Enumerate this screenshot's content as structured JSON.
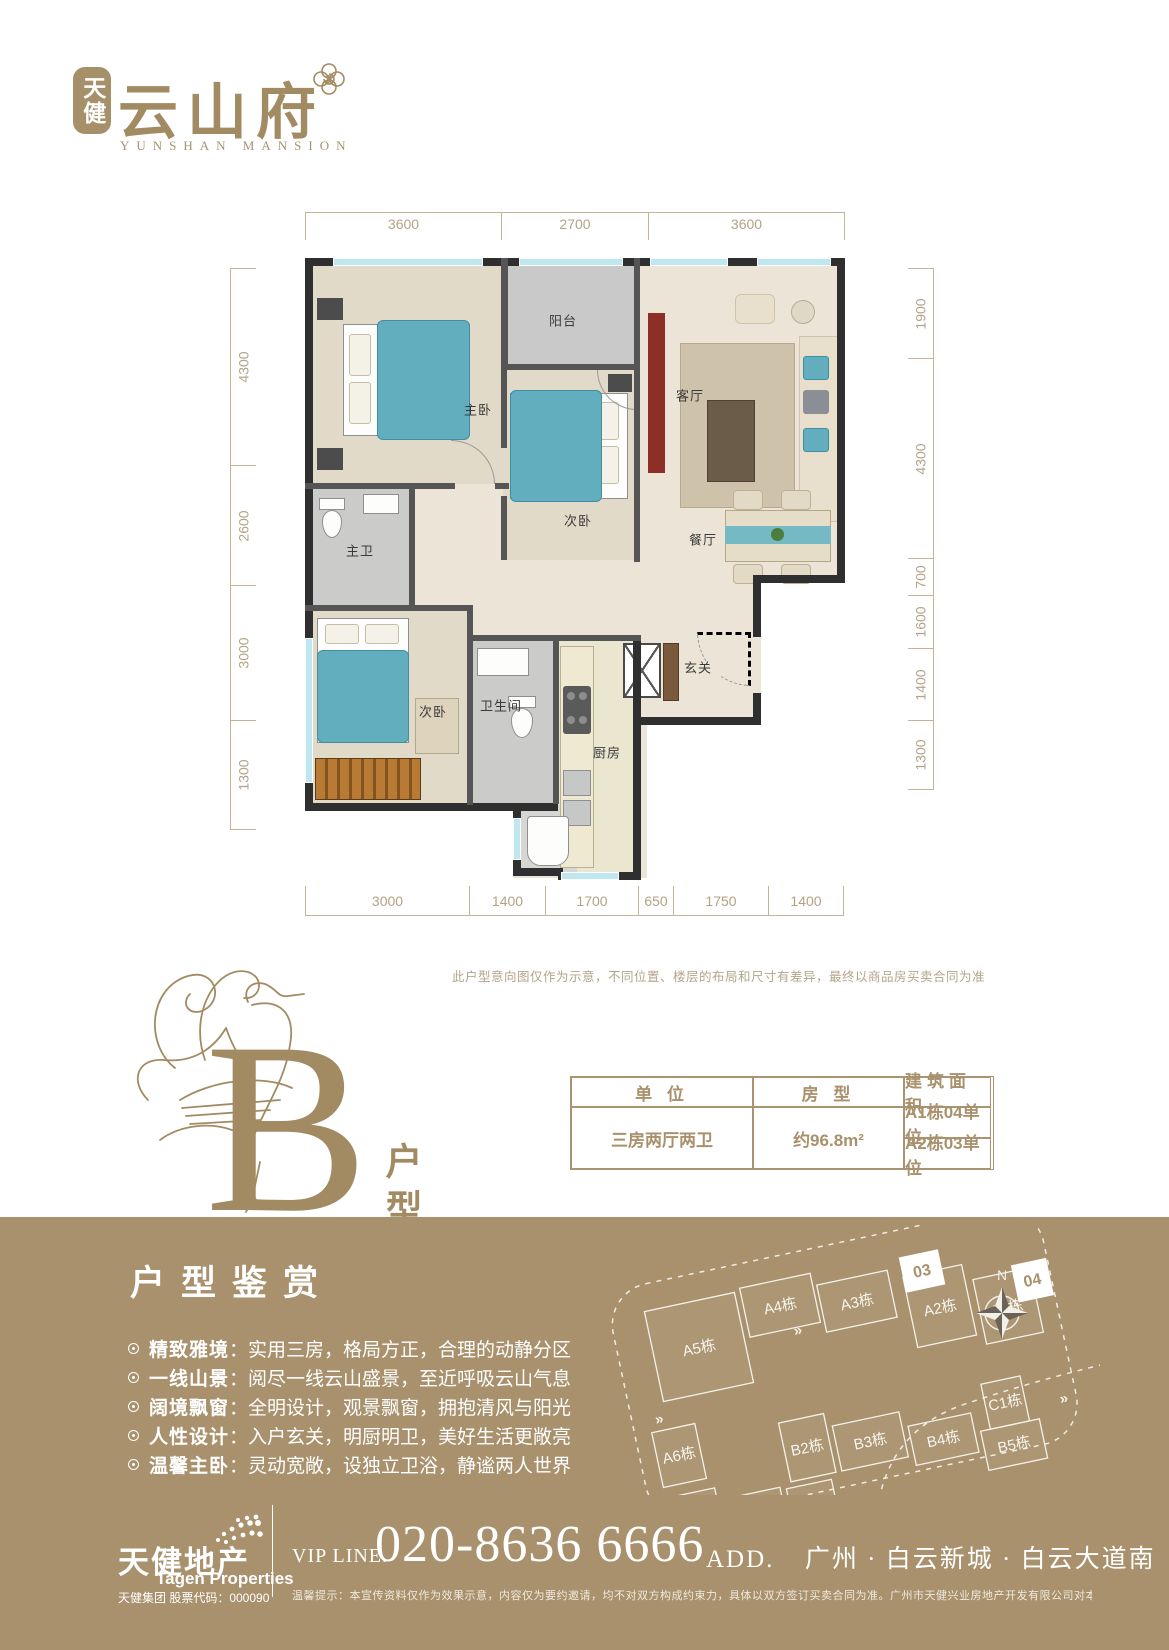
{
  "brand": {
    "badge_chars": "天健",
    "name": "云山府",
    "name_en": "YUNSHAN MANSION"
  },
  "floorplan": {
    "dims_top": [
      "3600",
      "2700",
      "3600"
    ],
    "dims_left": [
      "4300",
      "2600",
      "3000",
      "1300"
    ],
    "dims_right": [
      "1900",
      "4300",
      "700",
      "1600",
      "1400",
      "1300"
    ],
    "dims_bottom": [
      "3000",
      "1400",
      "1700",
      "650",
      "1750",
      "1400"
    ],
    "rooms": {
      "master": "主卧",
      "balcony": "阳台",
      "living": "客厅",
      "bed2": "次卧",
      "dining": "餐厅",
      "masterbath": "主卫",
      "bed3": "次卧",
      "bath": "卫生间",
      "kitchen": "厨房",
      "entry": "玄关"
    },
    "disclaimer": "此户型意向图仅作为示意，不同位置、楼层的布局和尺寸有差异，最终以商品房买卖合同为准"
  },
  "unit": {
    "letter": "B",
    "type_label": "户型",
    "table": {
      "headers": [
        "单 位",
        "房 型",
        "建筑面积"
      ],
      "units": [
        "A1栋04单位",
        "A2栋03单位"
      ],
      "room_type": "三房两厅两卫",
      "area": "约96.8m²"
    }
  },
  "features": {
    "title": "户型鉴赏",
    "colon": "：",
    "items": [
      {
        "label": "精致雅境",
        "text": "实用三房，格局方正，合理的动静分区"
      },
      {
        "label": "一线山景",
        "text": "阅尽一线云山盛景，至近呼吸云山气息"
      },
      {
        "label": "阔境飘窗",
        "text": "全明设计，观景飘窗，拥抱清风与阳光"
      },
      {
        "label": "人性设计",
        "text": "入户玄关，明厨明卫，美好生活更敞亮"
      },
      {
        "label": "温馨主卧",
        "text": "灵动宽敞，设独立卫浴，静谧两人世界"
      }
    ]
  },
  "sitemap": {
    "north_label": "N",
    "buildings": [
      "A5栋",
      "A4栋",
      "A3栋",
      "A2栋",
      "A1栋",
      "A6栋",
      "A7栋",
      "A8栋",
      "B1栋",
      "B2栋",
      "B3栋",
      "B4栋",
      "B5栋",
      "C1栋"
    ],
    "units": [
      "03",
      "04"
    ]
  },
  "footer": {
    "company_cn": "天健地产",
    "company_en": "Tagen Properties",
    "stock": "天健集团  股票代码：000090",
    "vip_label": "VIP LINE.",
    "phone": "020-8636 6666",
    "addr_label": "ADD.",
    "address": "广州 · 白云新城 · 白云大道南",
    "legal": "温馨提示：本宣传资料仅作为效果示意，内容仅为要约邀请，均不对双方构成约束力，具体以双方签订买卖合同为准。广州市天健兴业房地产开发有限公司对本资料享有最终解释权。"
  }
}
